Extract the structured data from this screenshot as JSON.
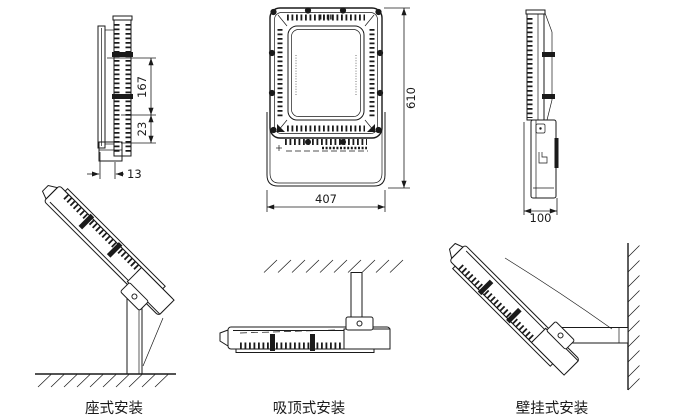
{
  "drawing": {
    "views": {
      "side_left": {
        "dim_vertical_upper": "167",
        "dim_vertical_lower": "23",
        "dim_horizontal": "13"
      },
      "front": {
        "dim_height": "610",
        "dim_width": "407"
      },
      "side_right": {
        "dim_width": "100"
      }
    },
    "mounts": [
      {
        "label": "座式安装"
      },
      {
        "label": "吸顶式安装"
      },
      {
        "label": "壁挂式安装"
      }
    ],
    "colors": {
      "line": "#1a1a1a",
      "background": "#ffffff"
    }
  }
}
